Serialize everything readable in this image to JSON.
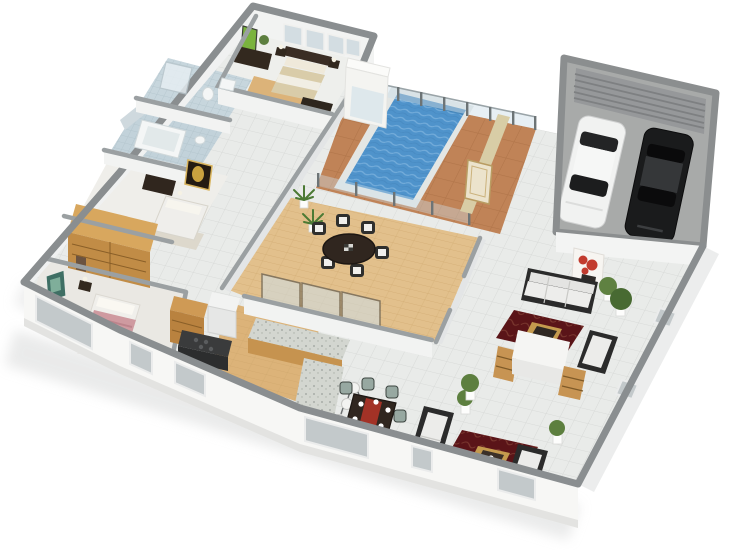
{
  "scene": {
    "type": "3d-isometric-floor-plan-render",
    "view": "dollhouse cutaway, single storey house seen from above at an angle",
    "background": "#ffffff"
  },
  "palette": {
    "background": "#ffffff",
    "wall_cap": "#8a8e90",
    "interior_wall_cap": "#9ba0a2",
    "exterior_wall_face": "#f7f7f5",
    "tile_floor": "#e9ebe9",
    "wood_floor": "#e2c08c",
    "kitchen_wood_floor": "#dcb379",
    "deck": "#c08357",
    "pool_water": "#4f93cb",
    "pool_coping": "#e3e6e4",
    "glass": "#cfe0ea",
    "khaki_wall": "#d8cda6",
    "wardrobe_wood": "#d8a75e",
    "wardrobe_wood_face": "#c18c46",
    "rug_dark_red": "#5a1418",
    "garage_floor": "#a8aaa9",
    "garage_door": "#96989a",
    "car_white": "#f1f2f1",
    "car_black": "#1a1b1c",
    "sofa_frame": "#2b2b2b",
    "sofa_cushion": "#ededeb",
    "coffee_table_wood": "#c49a4e",
    "dining_table": "#30261f",
    "plant_green": "#5d7f3f",
    "bath_tile": "#c7d6dd",
    "art_green": "#7ab33e",
    "art_red": "#c23b2e",
    "art_gold": "#caa23f",
    "bed_beige": "#d9cca9",
    "bed_pink": "#cf9aa0"
  },
  "rooms": [
    {
      "id": "master-bedroom",
      "area": "top of left wing",
      "furniture": [
        "double bed with dark headboard",
        "two nightstands with lamps",
        "foot bench",
        "dark media dresser",
        "green wall art",
        "potted plant"
      ],
      "windows_on_back_wall": 4
    },
    {
      "id": "master-closet",
      "area": "beside master bedroom",
      "floor": "wood"
    },
    {
      "id": "bathroom-1",
      "area": "left wing",
      "fixtures": [
        "glass shower",
        "toilet",
        "sink"
      ],
      "floor": "blue tile"
    },
    {
      "id": "bathroom-2",
      "area": "left wing",
      "fixtures": [
        "bathtub",
        "sink"
      ],
      "floor": "blue tile"
    },
    {
      "id": "bedroom-2",
      "area": "middle of left wing",
      "furniture": [
        "bed",
        "dark dresser",
        "gold framed art",
        "rug"
      ]
    },
    {
      "id": "walk-in-wardrobe",
      "area": "between bedroom-2 and bedroom-3",
      "furniture": [
        "large wooden wardrobe with shelves"
      ]
    },
    {
      "id": "bedroom-3",
      "area": "bottom left",
      "furniture": [
        "bed with pink patterned duvet",
        "dark footboard",
        "nightstand with lamp",
        "teal-green wall art"
      ]
    },
    {
      "id": "pool-terrace",
      "area": "center top",
      "features": [
        "rectangular pool",
        "glass safety fence with metal posts",
        "terracotta deck",
        "outdoor shower cubicle"
      ]
    },
    {
      "id": "dining-room",
      "area": "center",
      "floor": "wood planks",
      "furniture": [
        "round dark dining table",
        "6 chairs with white cushions",
        "2 palm plants",
        "sliding glass doors"
      ]
    },
    {
      "id": "kitchen",
      "area": "bottom center",
      "furniture": [
        "L-shaped island with granite top",
        "3 bar stools",
        "wood pantry cabinet",
        "fridge",
        "dark cooker counter"
      ]
    },
    {
      "id": "breakfast-nook",
      "area": "bottom center",
      "furniture": [
        "rectangular table with red runner and place settings",
        "6 grey-green chairs",
        "potted plant"
      ]
    },
    {
      "id": "entry-hall",
      "area": "between pool and garage",
      "features": [
        "khaki wall",
        "cream door"
      ]
    },
    {
      "id": "living-room",
      "area": "right wing",
      "floor": "white tile",
      "furniture": [
        "white sofa with dark frame",
        "red flower canvas art",
        "dark red rug with gold coffee table",
        "chaise bench",
        "white partition with 2 wooden bookcases",
        "second dark red rug with wood coffee table",
        "2 bench sofas",
        "5 potted plants"
      ]
    },
    {
      "id": "garage",
      "area": "top right",
      "features": [
        "ribbed roller door",
        "grey floor"
      ],
      "vehicles": [
        {
          "type": "sedan",
          "color": "white"
        },
        {
          "type": "sedan",
          "color": "black"
        }
      ]
    }
  ],
  "counts": {
    "dining_chairs": 6,
    "nook_chairs": 6,
    "bar_stools": 3,
    "rugs": 2,
    "cars": 2,
    "pool_fence_posts_back": 9,
    "pool_fence_posts_front": 5,
    "front_windows": 6
  }
}
